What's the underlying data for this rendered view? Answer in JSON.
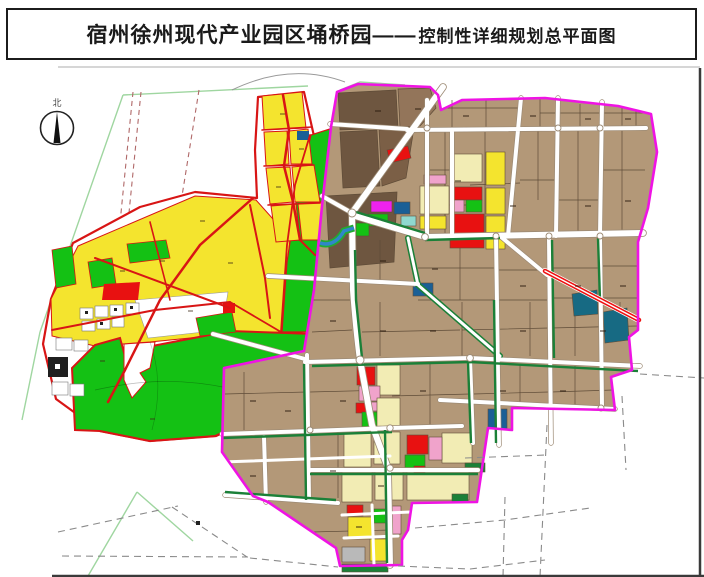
{
  "title": {
    "main": "宿州徐州现代产业园区埇桥园——",
    "sub": "控制性详细规划总平面图"
  },
  "compass": {
    "north_label": "北"
  },
  "palette": {
    "paper": "#ffffff",
    "frame_black": "#3a3a3a",
    "underline_gray": "#c9c9c9",
    "survey_green": "#9fd6a0",
    "dashed_red_road": "#b06868",
    "dash_gray": "#8a8a8a",
    "road_red": "#d81515",
    "parcel_yellow": "#f4e42e",
    "parcel_green": "#14c114",
    "parcel_red": "#e81111",
    "parcel_black": "#1f1f1f",
    "right_boundary_magenta": "#ef13e4",
    "ind_brown": "#b39878",
    "ind_brown_dark": "#6e5640",
    "ind_brown_mid": "#93755a",
    "ind_brown_dark2": "#7b5f46",
    "parcel_line": "#5f4c38",
    "road_white": "#ffffff",
    "road_casing": "#9c8a74",
    "cream": "#f2ecb4",
    "pink": "#f0a3cb",
    "magenta_parcel": "#ee22ee",
    "blue_parcel": "#1a5f96",
    "teal_parcel": "#176a83",
    "cyan_parcel": "#8fd8cf",
    "gray_parcel": "#b9b9b9",
    "strip_green_dark": "#1b8038",
    "canal_blue": "#2f86c9",
    "highway_red": "#ee1111"
  }
}
